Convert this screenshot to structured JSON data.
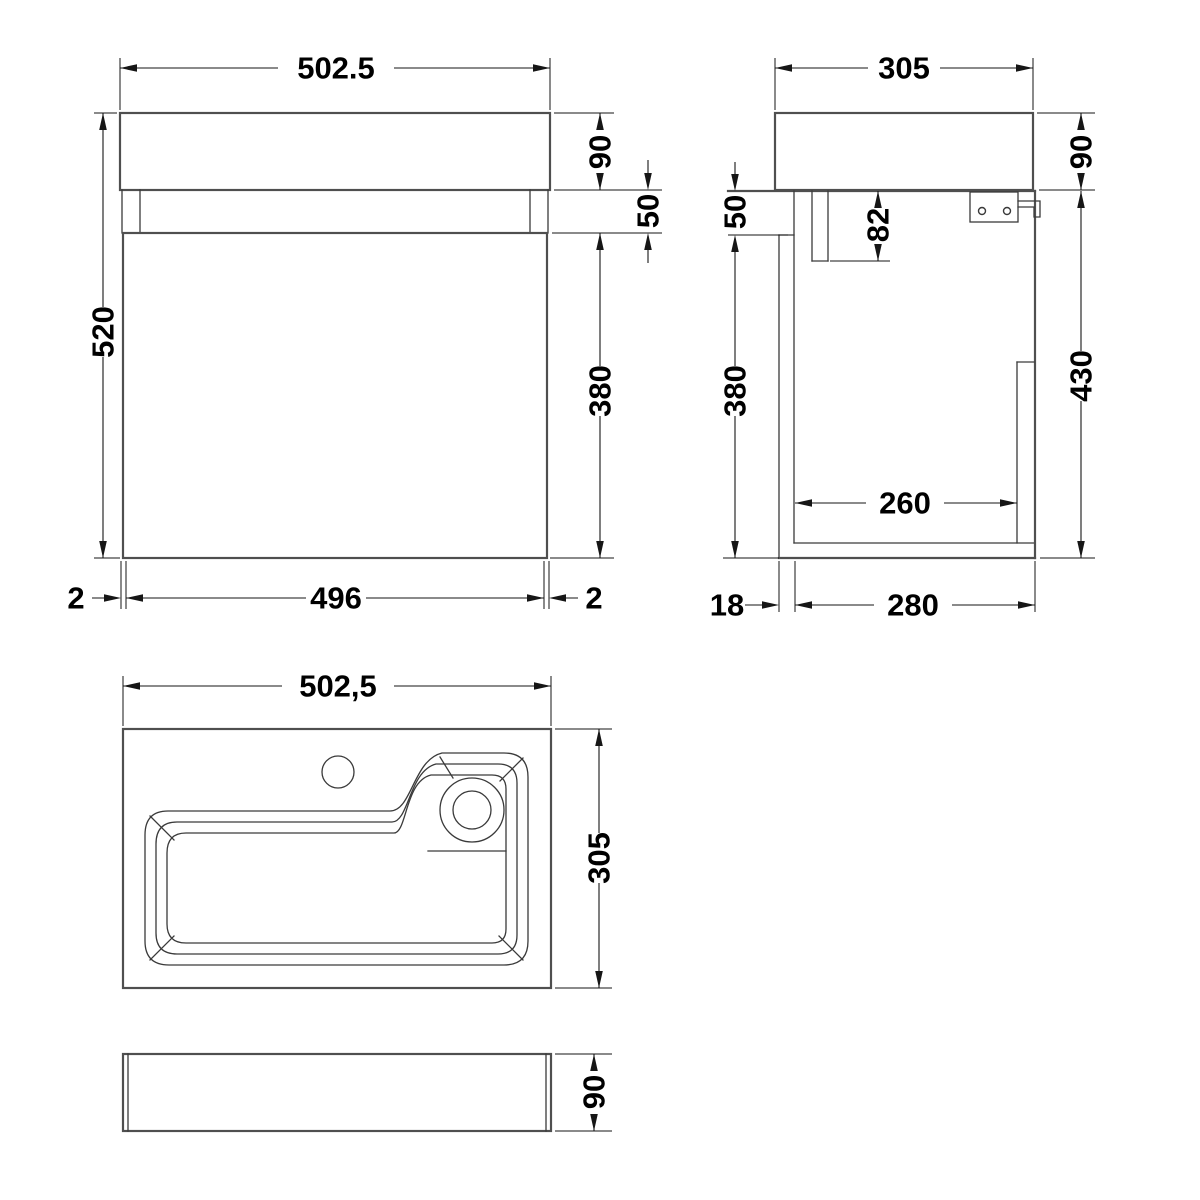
{
  "drawing": {
    "front_view": {
      "width": "502.5",
      "basin_height": "90",
      "recess_height": "50",
      "door_height": "380",
      "total_height": "520",
      "edge_left": "2",
      "door_width": "496",
      "edge_right": "2"
    },
    "side_view": {
      "depth": "305",
      "basin_height": "90",
      "recess_height": "50",
      "apron_drop": "82",
      "door_height": "380",
      "hang_height": "430",
      "internal_depth": "260",
      "back_panel": "18",
      "cabinet_depth": "280"
    },
    "plan_view": {
      "width": "502,5",
      "depth": "305"
    },
    "bottom_view": {
      "height": "90"
    }
  }
}
